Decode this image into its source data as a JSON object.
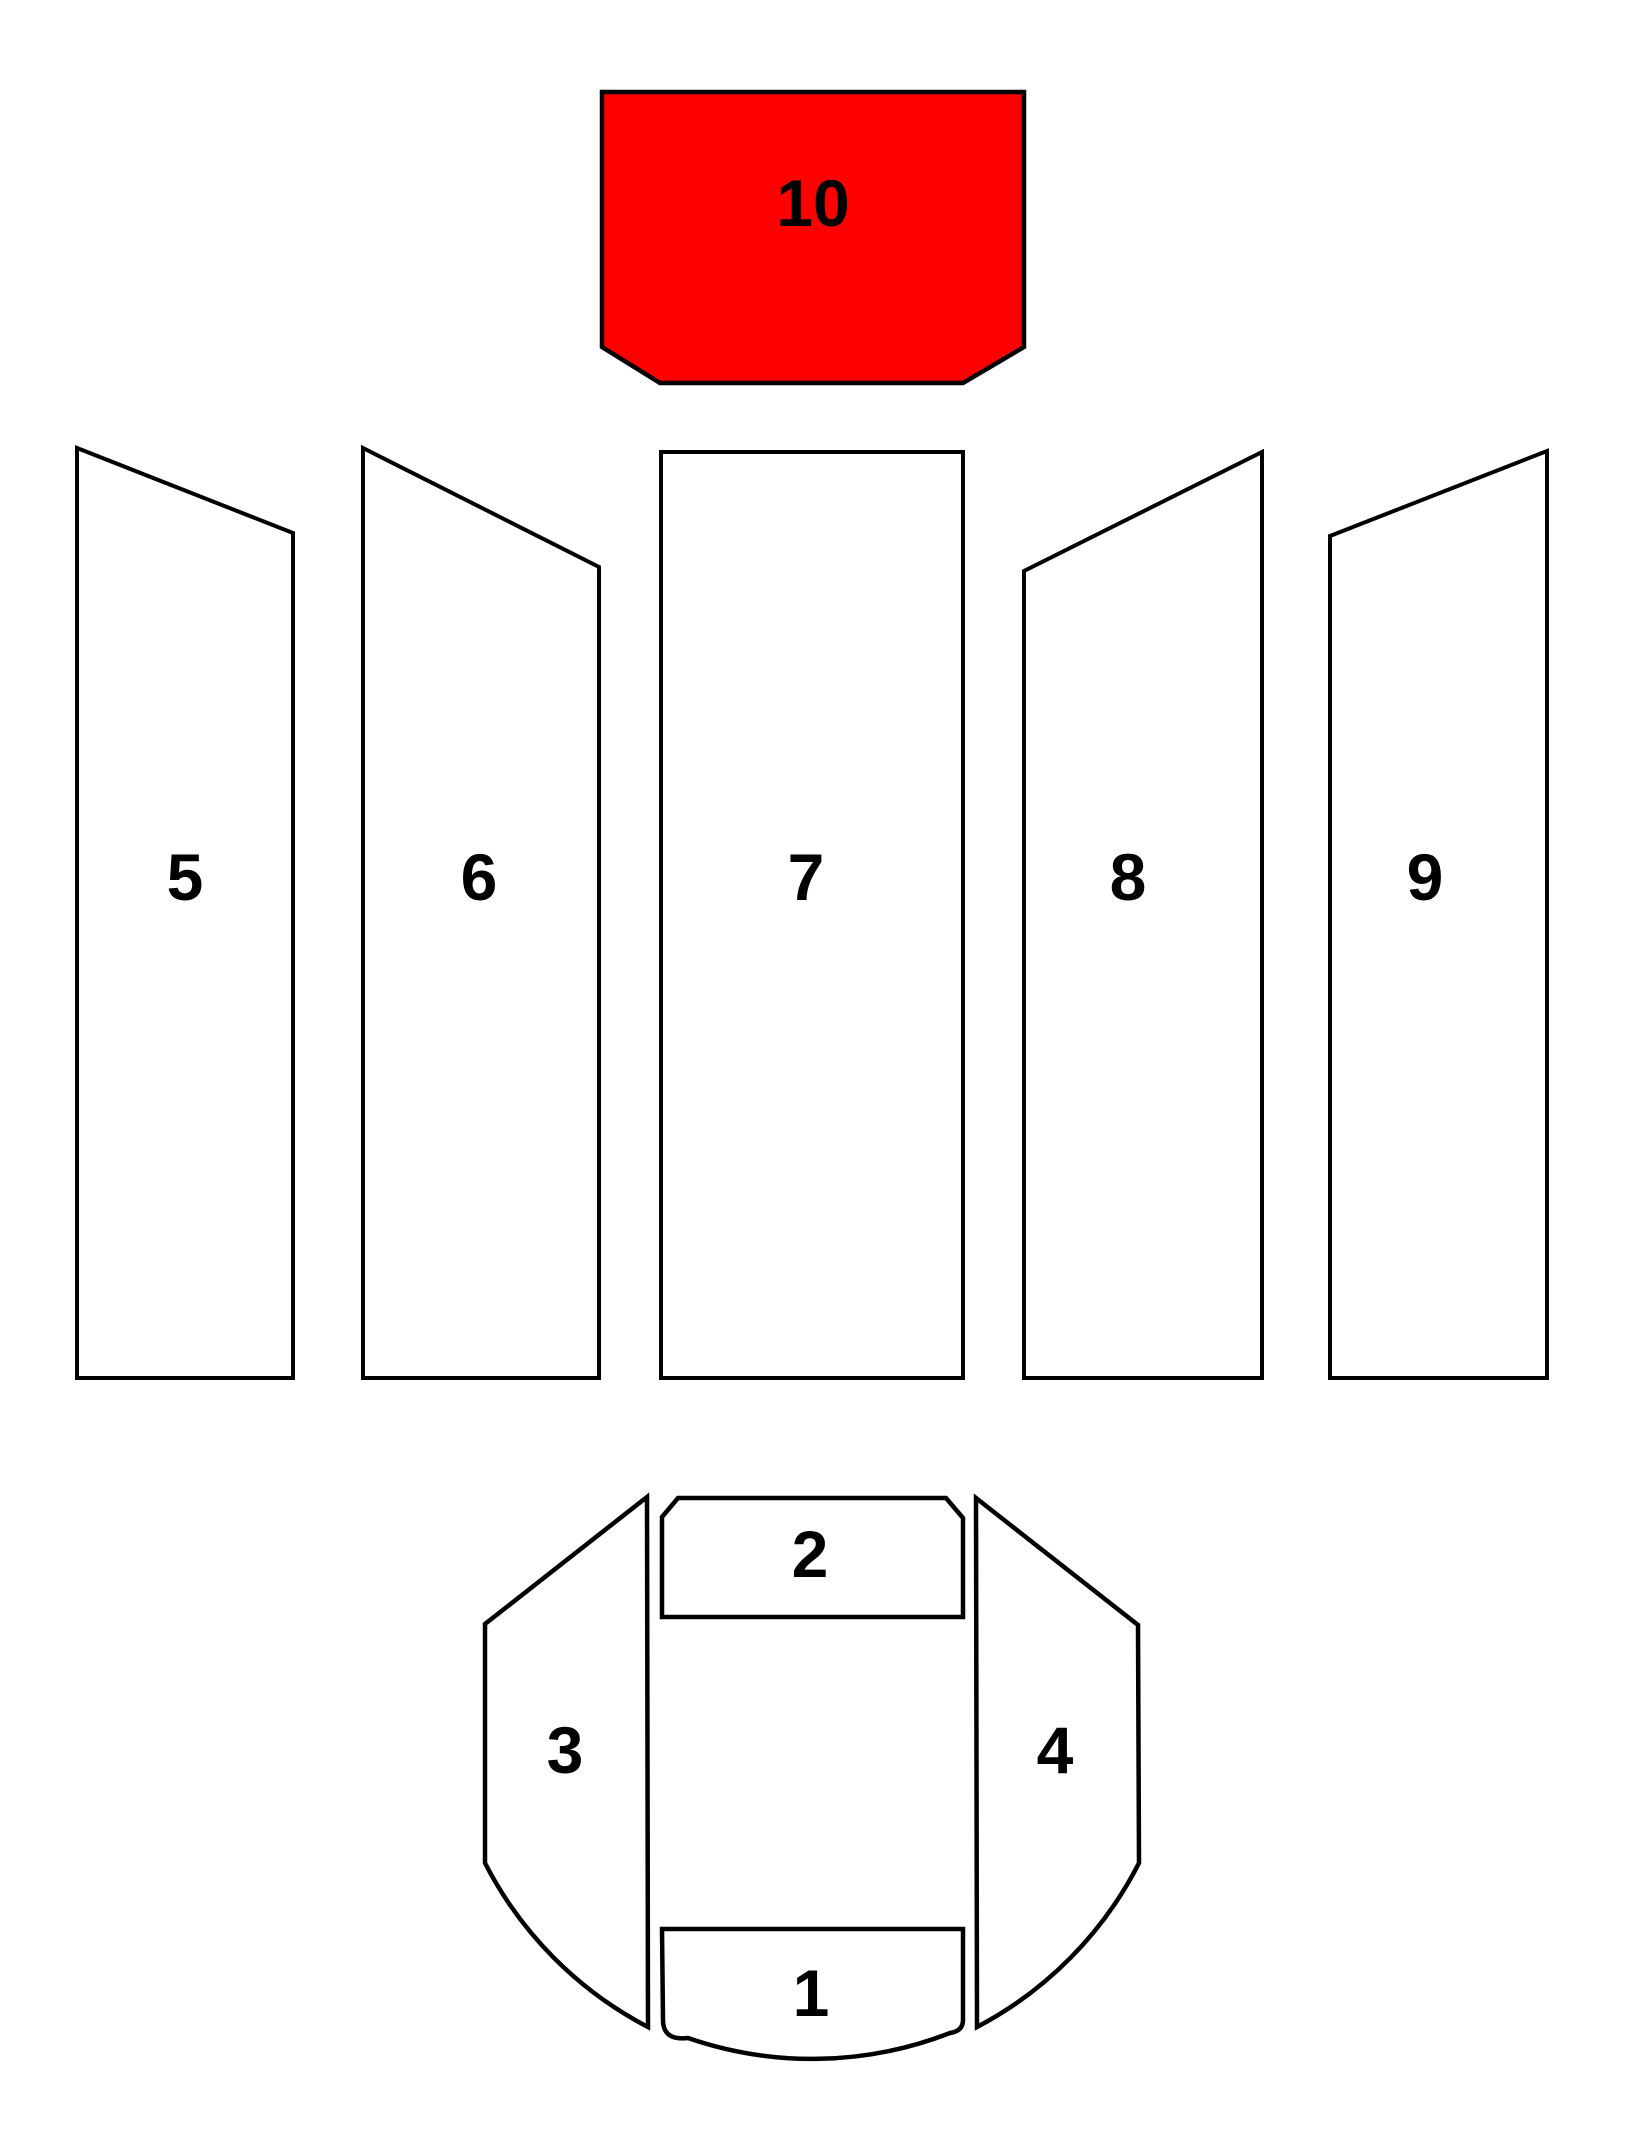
{
  "diagram": {
    "background_color": "#ffffff",
    "outline_color": "#000000",
    "highlight_color": "#ff0000",
    "part_fill_color": "#ffffff",
    "highlighted_part": "10",
    "parts": [
      {
        "id": "1",
        "label": "1",
        "highlighted": false
      },
      {
        "id": "2",
        "label": "2",
        "highlighted": false
      },
      {
        "id": "3",
        "label": "3",
        "highlighted": false
      },
      {
        "id": "4",
        "label": "4",
        "highlighted": false
      },
      {
        "id": "5",
        "label": "5",
        "highlighted": false
      },
      {
        "id": "6",
        "label": "6",
        "highlighted": false
      },
      {
        "id": "7",
        "label": "7",
        "highlighted": false
      },
      {
        "id": "8",
        "label": "8",
        "highlighted": false
      },
      {
        "id": "9",
        "label": "9",
        "highlighted": false
      },
      {
        "id": "10",
        "label": "10",
        "highlighted": true
      }
    ]
  }
}
